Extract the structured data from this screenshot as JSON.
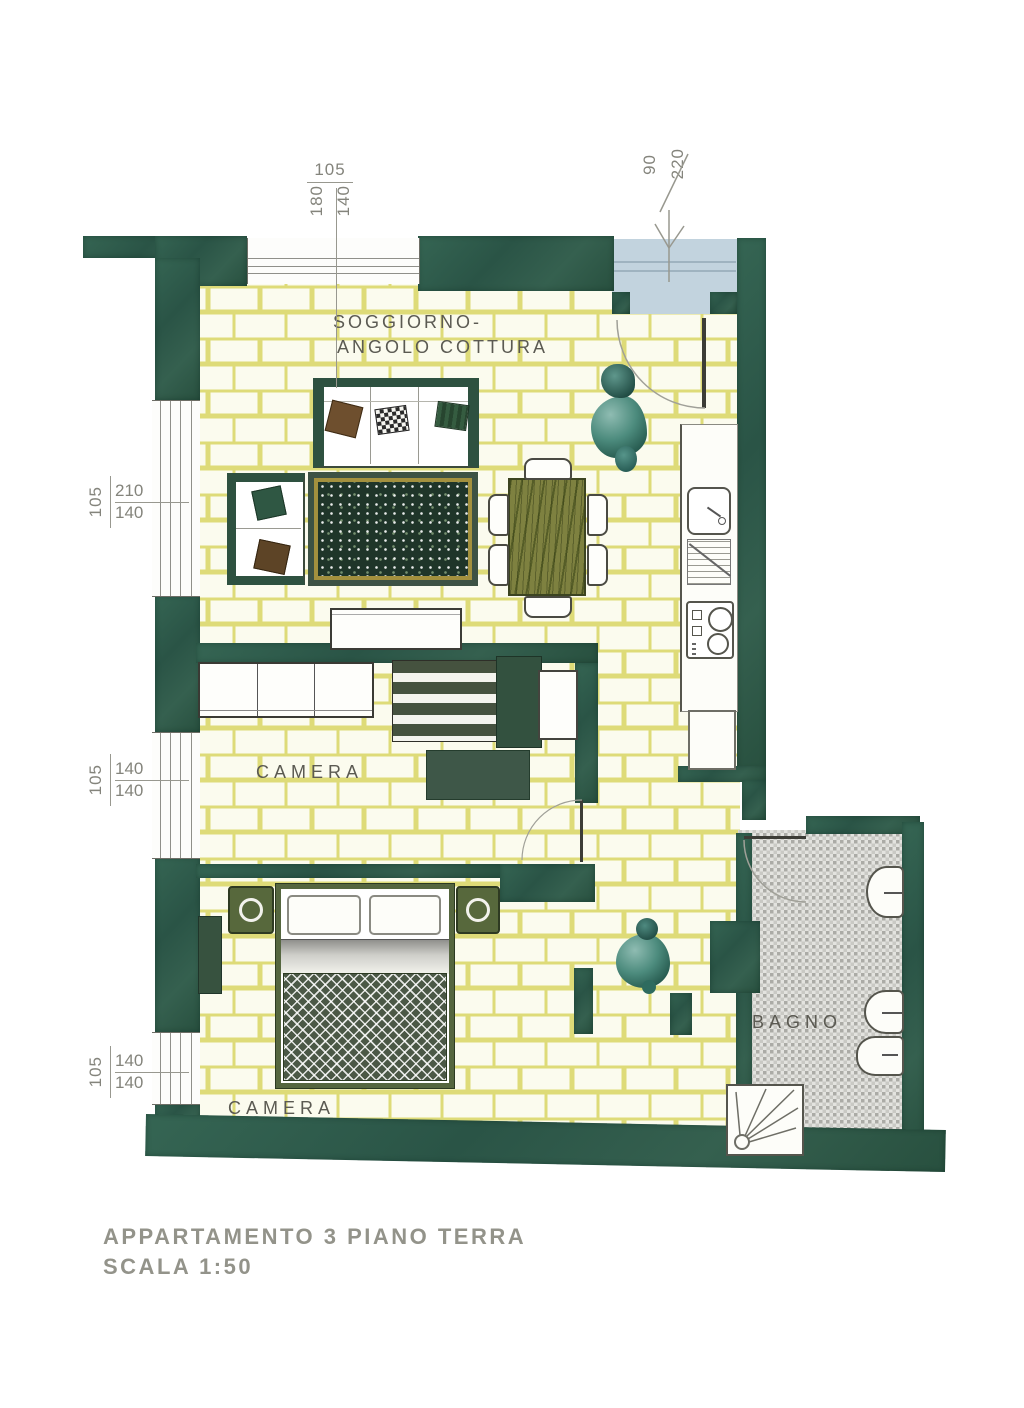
{
  "document": {
    "type": "apartment floor plan (scanned drawing)",
    "title": {
      "line1": "APPARTAMENTO 3 PIANO TERRA",
      "line2": "SCALA 1:50"
    }
  },
  "rooms": {
    "soggiorno": {
      "label1": "SOGGIORNO-",
      "label2": "ANGOLO COTTURA"
    },
    "camera1": {
      "label": "CAMERA"
    },
    "camera2": {
      "label": "CAMERA"
    },
    "bagno": {
      "label": "BAGNO"
    }
  },
  "dims": {
    "top": {
      "width": "105",
      "upper": "180",
      "lower": "140"
    },
    "entry": {
      "width": "90",
      "height": "220"
    },
    "left1": {
      "width": "105",
      "upper": "210",
      "lower": "140"
    },
    "left2": {
      "width": "105",
      "upper": "140",
      "lower": "140"
    },
    "left3": {
      "width": "105",
      "upper": "140",
      "lower": "140"
    }
  },
  "colors": {
    "wall": "#2e5c4c",
    "brick_grout": "#dedb78",
    "brick_fill": "#fbfbee",
    "bath_tile_dark": "#ababa6",
    "bath_tile_light": "#e3e3df",
    "vestibule_floor": "#c2d3de",
    "rug_field": "#1f3529",
    "rug_border": "#a3903e",
    "table_wood": "#7e8140",
    "blanket": "#4b5846"
  },
  "furniture_icons": [
    "sofa",
    "armchair",
    "rug",
    "tv-cabinet",
    "dining-table",
    "dining-chair",
    "kitchen-sink",
    "stove",
    "fridge",
    "wardrobe",
    "striped-dresser",
    "cabinet",
    "desk",
    "double-bed",
    "nightstand",
    "radiator",
    "toilet",
    "bidet",
    "washbasin",
    "shower",
    "plant-entry",
    "plant-hall"
  ]
}
